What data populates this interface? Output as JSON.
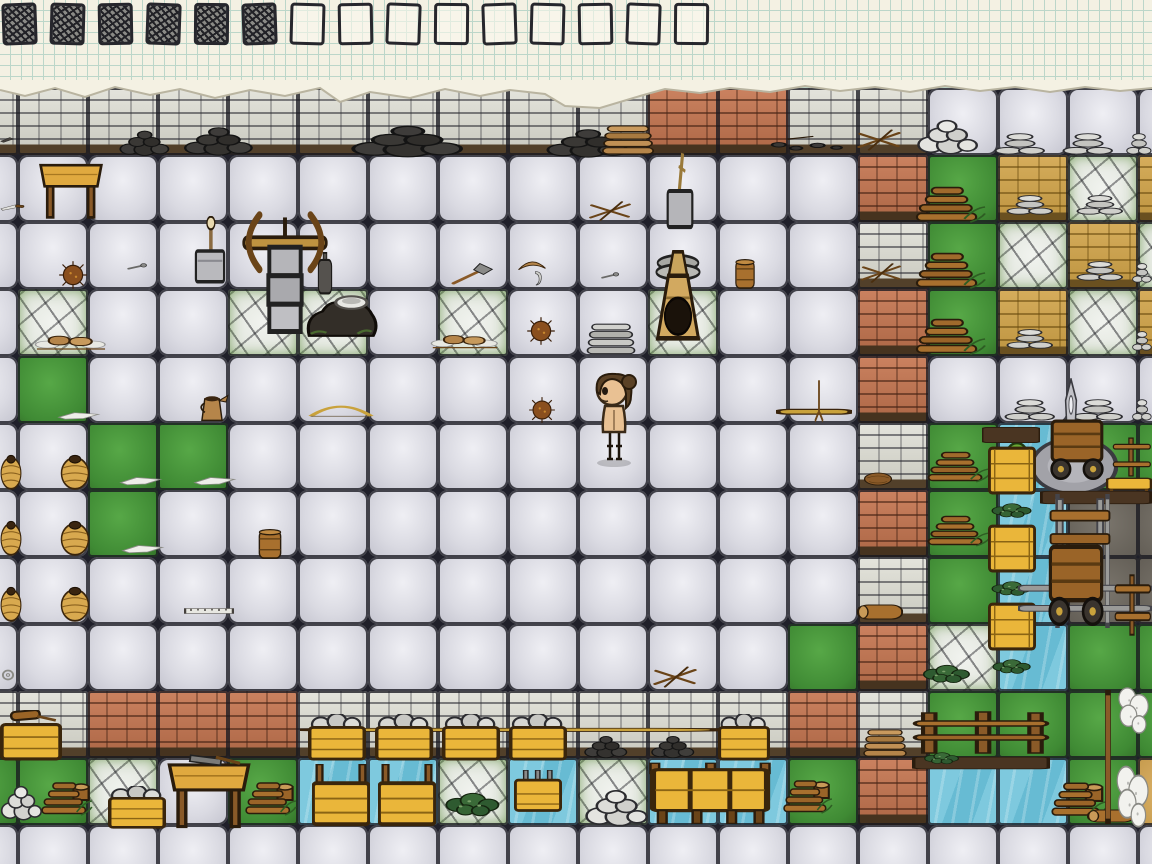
{
  "hud": {
    "checklist": {
      "total_tasks": 15,
      "completed_tasks": 6
    }
  },
  "palette": {
    "paper": "#f4f1e3",
    "paper_grid": "#bcd6c9",
    "ink": "#26262c",
    "stone_floor": "#dadae2",
    "stone_wall": "#d5d5cb",
    "brick_wall": "#bc7252",
    "adobe_wall": "#cda24e",
    "flagstone": "#e9ece6",
    "grass": "#479a38",
    "water": "#74c4dc",
    "road": "#6e695f",
    "adobe_floor": "#d2a95c",
    "crate_wood": "#eab63a",
    "skin": "#e9c193",
    "hair": "#5b4226"
  },
  "scene": {
    "grid": {
      "tileW": 70,
      "tileH": 67,
      "originX": -52,
      "originY": 88,
      "cols": 18,
      "rows": 12
    },
    "legend": {
      "F": "stone-floor",
      "W": "stone-wall",
      "B": "brick-wall",
      "A": "adobe-wall",
      "C": "flagstone-moss",
      "G": "grass",
      "D": "water",
      "R": "dirt-road",
      "Y": "adobe-floor"
    },
    "floors": [
      "WWWWWWWWWWBBWWFFFF",
      "FFFFFFFFFFFFFBGACA",
      "FFFFFFFFFFFFFWGCAC",
      "FCFFCCFCFFCFFBGACA",
      "FGFFFFFFFFFFFBFFFF",
      "FFGGFFFFFFFFFWGDGG",
      "FFGFFFFFFFFFFBGDRR",
      "FFFFFFFFFFFFFWGDRR",
      "FFFFFFFFFFFFGBCDGG",
      "WWBBBWWWWWWWBWGGGG",
      "GGCFGDDCDCDDGBDDGY",
      "FFFFFFFFFFFFFFFFFF"
    ],
    "object_names": {
      "table": "wooden-table",
      "table-tools": "work-table-with-tools",
      "pot": "clay-pot",
      "crate": "wooden-crate",
      "crate-stones": "crate-of-stones",
      "crate-posts": "crate-with-fence-posts",
      "crate-pegs": "crate-with-pegs",
      "crate-mallet": "crate-with-mallet",
      "bench3": "long-wooden-bin",
      "firewood": "firewood-pile",
      "firewood-stump": "firewood-pile-with-stump",
      "flatstack": "flat-rock-stack",
      "stonepile": "round-stone-pile",
      "orepile": "iron-ore-pile",
      "orepile-sparse": "scattered-ore-bits",
      "kindling": "crossed-kindling",
      "platestack-grey": "flagstone-stack",
      "platestack-brown": "clay-plate-stack",
      "kiln": "adobe-kiln",
      "forge": "forge-with-bowl",
      "stonecolumn-bow": "stone-block-stack-with-bow-drill",
      "block-tool": "stone-block-with-hammer",
      "block-shovel": "stone-block-with-shovel",
      "crucible": "crucible",
      "barrel-small": "small-barrel",
      "pitcher": "clay-pitcher",
      "bow": "hunting-bow",
      "burdock": "burdock-root",
      "flint": "flint-chip",
      "knife": "flint-knife",
      "knife-small": "small-blade",
      "hatchet": "stone-hatchet",
      "boomerang": "boomerang",
      "hook": "bone-hook",
      "bolt": "iron-bolt",
      "ruler": "measuring-stick",
      "rope": "rope-coil",
      "loaves": "bread-loaves",
      "greens": "greens-pile",
      "nest": "bird-nest",
      "log": "wooden-log",
      "shaft-h": "long-straight-shaft",
      "pole-v": "wooden-stake",
      "dirt": "dirt-strip",
      "fence": "split-rail-fence",
      "fence-rack": "fence-rail-section",
      "bench": "wooden-bench",
      "tree": "small-tree",
      "sheep": "domestic-sheep",
      "disc": "grindstone-base",
      "fin": "metal-blade",
      "cart": "hand-cart",
      "cartframe": "cart-frame",
      "rails-h": "rail-track-horizontal",
      "rail-v": "rail-track-vertical",
      "fence-bar-v": "pen-fence-post",
      "character": "player-character"
    },
    "objects": [
      {
        "type": "orepile",
        "x": 118,
        "y": 126,
        "w": 58,
        "h": 32
      },
      {
        "type": "orepile",
        "x": 182,
        "y": 122,
        "w": 80,
        "h": 36
      },
      {
        "type": "orepile",
        "x": 348,
        "y": 120,
        "w": 130,
        "h": 40
      },
      {
        "type": "orepile",
        "x": 544,
        "y": 124,
        "w": 96,
        "h": 36
      },
      {
        "type": "platestack-brown",
        "x": 598,
        "y": 124,
        "w": 60,
        "h": 34
      },
      {
        "type": "orepile-sparse",
        "x": 766,
        "y": 128,
        "w": 86,
        "h": 28
      },
      {
        "type": "kindling",
        "x": 854,
        "y": 126,
        "w": 50,
        "h": 28
      },
      {
        "type": "stonepile",
        "x": 916,
        "y": 118,
        "w": 62,
        "h": 38
      },
      {
        "type": "flatstack",
        "x": 994,
        "y": 132,
        "w": 52,
        "h": 24
      },
      {
        "type": "flatstack",
        "x": 1062,
        "y": 132,
        "w": 52,
        "h": 24
      },
      {
        "type": "flatstack",
        "x": 1126,
        "y": 132,
        "w": 26,
        "h": 24
      },
      {
        "type": "knife-small",
        "x": 0,
        "y": 135,
        "w": 14,
        "h": 9
      },
      {
        "type": "table",
        "x": 38,
        "y": 156,
        "w": 66,
        "h": 66
      },
      {
        "type": "knife",
        "x": 0,
        "y": 200,
        "w": 26,
        "h": 14
      },
      {
        "type": "kindling",
        "x": 586,
        "y": 198,
        "w": 48,
        "h": 26
      },
      {
        "type": "block-shovel",
        "x": 658,
        "y": 150,
        "w": 44,
        "h": 82
      },
      {
        "type": "block-tool",
        "x": 188,
        "y": 216,
        "w": 44,
        "h": 70
      },
      {
        "type": "stonecolumn-bow",
        "x": 236,
        "y": 210,
        "w": 98,
        "h": 124
      },
      {
        "type": "crucible",
        "x": 314,
        "y": 252,
        "w": 22,
        "h": 44
      },
      {
        "type": "forge",
        "x": 303,
        "y": 288,
        "w": 78,
        "h": 52
      },
      {
        "type": "burdock",
        "x": 58,
        "y": 260,
        "w": 30,
        "h": 30
      },
      {
        "type": "bolt",
        "x": 126,
        "y": 260,
        "w": 22,
        "h": 14
      },
      {
        "type": "hatchet",
        "x": 450,
        "y": 262,
        "w": 44,
        "h": 26
      },
      {
        "type": "boomerang",
        "x": 516,
        "y": 253,
        "w": 32,
        "h": 22
      },
      {
        "type": "hook",
        "x": 530,
        "y": 270,
        "w": 16,
        "h": 18
      },
      {
        "type": "bolt",
        "x": 600,
        "y": 269,
        "w": 20,
        "h": 14
      },
      {
        "type": "kindling",
        "x": 858,
        "y": 260,
        "w": 46,
        "h": 26
      },
      {
        "type": "barrel-small",
        "x": 733,
        "y": 258,
        "w": 24,
        "h": 32
      },
      {
        "type": "loaves",
        "x": 34,
        "y": 326,
        "w": 74,
        "h": 32
      },
      {
        "type": "burdock",
        "x": 526,
        "y": 316,
        "w": 30,
        "h": 30
      },
      {
        "type": "loaves",
        "x": 430,
        "y": 326,
        "w": 70,
        "h": 30
      },
      {
        "type": "platestack-grey",
        "x": 583,
        "y": 322,
        "w": 56,
        "h": 36
      },
      {
        "type": "kiln",
        "x": 648,
        "y": 250,
        "w": 60,
        "h": 92
      },
      {
        "type": "flatstack",
        "x": 1006,
        "y": 194,
        "w": 48,
        "h": 22
      },
      {
        "type": "flatstack",
        "x": 1076,
        "y": 194,
        "w": 48,
        "h": 22
      },
      {
        "type": "flatstack",
        "x": 1006,
        "y": 328,
        "w": 48,
        "h": 22
      },
      {
        "type": "flatstack",
        "x": 1076,
        "y": 260,
        "w": 48,
        "h": 22
      },
      {
        "type": "flatstack",
        "x": 1132,
        "y": 262,
        "w": 20,
        "h": 22
      },
      {
        "type": "flatstack",
        "x": 1132,
        "y": 330,
        "w": 20,
        "h": 22
      },
      {
        "type": "firewood",
        "x": 914,
        "y": 180,
        "w": 74,
        "h": 54
      },
      {
        "type": "firewood",
        "x": 914,
        "y": 246,
        "w": 74,
        "h": 54
      },
      {
        "type": "firewood",
        "x": 914,
        "y": 312,
        "w": 74,
        "h": 54
      },
      {
        "type": "flint",
        "x": 56,
        "y": 406,
        "w": 46,
        "h": 16
      },
      {
        "type": "pitcher",
        "x": 194,
        "y": 388,
        "w": 36,
        "h": 36
      },
      {
        "type": "bow",
        "x": 308,
        "y": 396,
        "w": 66,
        "h": 26
      },
      {
        "type": "burdock",
        "x": 528,
        "y": 396,
        "w": 28,
        "h": 28
      },
      {
        "type": "shaft-h",
        "x": 776,
        "y": 406,
        "w": 76,
        "h": 12
      },
      {
        "type": "pole-v",
        "x": 810,
        "y": 378,
        "w": 18,
        "h": 46
      },
      {
        "type": "flatstack",
        "x": 1004,
        "y": 398,
        "w": 52,
        "h": 24
      },
      {
        "type": "flatstack",
        "x": 1072,
        "y": 398,
        "w": 52,
        "h": 24
      },
      {
        "type": "flatstack",
        "x": 1132,
        "y": 398,
        "w": 20,
        "h": 24
      },
      {
        "type": "nest",
        "x": 862,
        "y": 468,
        "w": 32,
        "h": 20
      },
      {
        "type": "tree",
        "x": 998,
        "y": 441,
        "w": 38,
        "h": 52
      },
      {
        "type": "disc",
        "x": 1030,
        "y": 436,
        "w": 88,
        "h": 60
      },
      {
        "type": "fin",
        "x": 1056,
        "y": 378,
        "w": 30,
        "h": 64
      },
      {
        "type": "cart",
        "x": 1046,
        "y": 416,
        "w": 62,
        "h": 64
      },
      {
        "type": "firewood",
        "x": 926,
        "y": 446,
        "w": 66,
        "h": 46
      },
      {
        "type": "firewood",
        "x": 926,
        "y": 510,
        "w": 66,
        "h": 46
      },
      {
        "type": "fence-rack",
        "x": 1110,
        "y": 436,
        "w": 42,
        "h": 42
      },
      {
        "type": "bench",
        "x": 1106,
        "y": 474,
        "w": 46,
        "h": 24
      },
      {
        "type": "pot",
        "x": 0,
        "y": 452,
        "w": 22,
        "h": 38
      },
      {
        "type": "pot",
        "x": 60,
        "y": 452,
        "w": 30,
        "h": 38
      },
      {
        "type": "pot",
        "x": 0,
        "y": 518,
        "w": 22,
        "h": 38
      },
      {
        "type": "pot",
        "x": 60,
        "y": 518,
        "w": 30,
        "h": 38
      },
      {
        "type": "pot",
        "x": 0,
        "y": 584,
        "w": 22,
        "h": 38
      },
      {
        "type": "pot",
        "x": 60,
        "y": 584,
        "w": 30,
        "h": 38
      },
      {
        "type": "flint",
        "x": 118,
        "y": 470,
        "w": 46,
        "h": 18
      },
      {
        "type": "flint",
        "x": 192,
        "y": 470,
        "w": 46,
        "h": 18
      },
      {
        "type": "flint",
        "x": 120,
        "y": 538,
        "w": 46,
        "h": 18
      },
      {
        "type": "barrel-small",
        "x": 256,
        "y": 528,
        "w": 28,
        "h": 32
      },
      {
        "type": "ruler",
        "x": 184,
        "y": 606,
        "w": 50,
        "h": 10
      },
      {
        "type": "rope",
        "x": 0,
        "y": 668,
        "w": 16,
        "h": 14
      },
      {
        "type": "kindling",
        "x": 650,
        "y": 663,
        "w": 50,
        "h": 28
      },
      {
        "type": "log",
        "x": 856,
        "y": 598,
        "w": 48,
        "h": 28
      },
      {
        "type": "dirt",
        "x": 982,
        "y": 426,
        "w": 58,
        "h": 18
      },
      {
        "type": "crate",
        "x": 988,
        "y": 444,
        "w": 48,
        "h": 52
      },
      {
        "type": "greens",
        "x": 989,
        "y": 498,
        "w": 46,
        "h": 22
      },
      {
        "type": "crate",
        "x": 988,
        "y": 522,
        "w": 48,
        "h": 52
      },
      {
        "type": "greens",
        "x": 989,
        "y": 576,
        "w": 46,
        "h": 22
      },
      {
        "type": "crate",
        "x": 988,
        "y": 600,
        "w": 48,
        "h": 52
      },
      {
        "type": "greens",
        "x": 990,
        "y": 654,
        "w": 44,
        "h": 22
      },
      {
        "type": "dirt",
        "x": 1040,
        "y": 490,
        "w": 112,
        "h": 15
      },
      {
        "type": "rail-v",
        "x": 1054,
        "y": 494,
        "w": 7,
        "h": 134
      },
      {
        "type": "rail-v",
        "x": 1104,
        "y": 494,
        "w": 7,
        "h": 134
      },
      {
        "type": "cartframe",
        "x": 1048,
        "y": 498,
        "w": 64,
        "h": 58
      },
      {
        "type": "rails-h",
        "x": 1018,
        "y": 581,
        "w": 134,
        "h": 36
      },
      {
        "type": "cart",
        "x": 1044,
        "y": 540,
        "w": 64,
        "h": 86
      },
      {
        "type": "fence-rack",
        "x": 1112,
        "y": 572,
        "w": 40,
        "h": 66
      },
      {
        "type": "greens",
        "x": 920,
        "y": 658,
        "w": 54,
        "h": 28
      },
      {
        "type": "fence",
        "x": 912,
        "y": 708,
        "w": 138,
        "h": 50
      },
      {
        "type": "dirt",
        "x": 912,
        "y": 756,
        "w": 138,
        "h": 14
      },
      {
        "type": "greens",
        "x": 922,
        "y": 748,
        "w": 40,
        "h": 18
      },
      {
        "type": "shaft-h",
        "x": 300,
        "y": 726,
        "w": 436,
        "h": 8
      },
      {
        "type": "crate-mallet",
        "x": 0,
        "y": 710,
        "w": 62,
        "h": 52
      },
      {
        "type": "crate-stones",
        "x": 308,
        "y": 714,
        "w": 58,
        "h": 48
      },
      {
        "type": "crate-stones",
        "x": 375,
        "y": 714,
        "w": 58,
        "h": 48
      },
      {
        "type": "crate-stones",
        "x": 442,
        "y": 714,
        "w": 58,
        "h": 48
      },
      {
        "type": "crate-stones",
        "x": 509,
        "y": 714,
        "w": 58,
        "h": 48
      },
      {
        "type": "orepile",
        "x": 583,
        "y": 732,
        "w": 50,
        "h": 28
      },
      {
        "type": "orepile",
        "x": 650,
        "y": 732,
        "w": 50,
        "h": 28
      },
      {
        "type": "crate-stones",
        "x": 718,
        "y": 714,
        "w": 52,
        "h": 48
      },
      {
        "type": "platestack-brown",
        "x": 860,
        "y": 728,
        "w": 50,
        "h": 32
      },
      {
        "type": "stonepile",
        "x": 0,
        "y": 784,
        "w": 42,
        "h": 38
      },
      {
        "type": "firewood-stump",
        "x": 40,
        "y": 776,
        "w": 54,
        "h": 50
      },
      {
        "type": "crate-stones",
        "x": 108,
        "y": 786,
        "w": 58,
        "h": 44
      },
      {
        "type": "table-tools",
        "x": 166,
        "y": 754,
        "w": 86,
        "h": 78
      },
      {
        "type": "firewood-stump",
        "x": 244,
        "y": 776,
        "w": 54,
        "h": 50
      },
      {
        "type": "crate-posts",
        "x": 312,
        "y": 764,
        "w": 58,
        "h": 64
      },
      {
        "type": "crate-posts",
        "x": 378,
        "y": 764,
        "w": 58,
        "h": 64
      },
      {
        "type": "greens",
        "x": 442,
        "y": 784,
        "w": 62,
        "h": 36
      },
      {
        "type": "crate-pegs",
        "x": 514,
        "y": 770,
        "w": 48,
        "h": 46
      },
      {
        "type": "stonepile",
        "x": 584,
        "y": 788,
        "w": 64,
        "h": 40
      },
      {
        "type": "bench3",
        "x": 648,
        "y": 762,
        "w": 124,
        "h": 64
      },
      {
        "type": "firewood-stump",
        "x": 782,
        "y": 774,
        "w": 52,
        "h": 50
      },
      {
        "type": "firewood-stump",
        "x": 1050,
        "y": 776,
        "w": 58,
        "h": 52
      },
      {
        "type": "log",
        "x": 1086,
        "y": 804,
        "w": 50,
        "h": 24
      },
      {
        "type": "fence-bar-v",
        "x": 1104,
        "y": 690,
        "w": 8,
        "h": 134
      },
      {
        "type": "sheep",
        "x": 1114,
        "y": 686,
        "w": 38,
        "h": 48
      },
      {
        "type": "sheep",
        "x": 1112,
        "y": 764,
        "w": 40,
        "h": 64
      },
      {
        "type": "character",
        "x": 588,
        "y": 370,
        "w": 54,
        "h": 100
      }
    ]
  }
}
